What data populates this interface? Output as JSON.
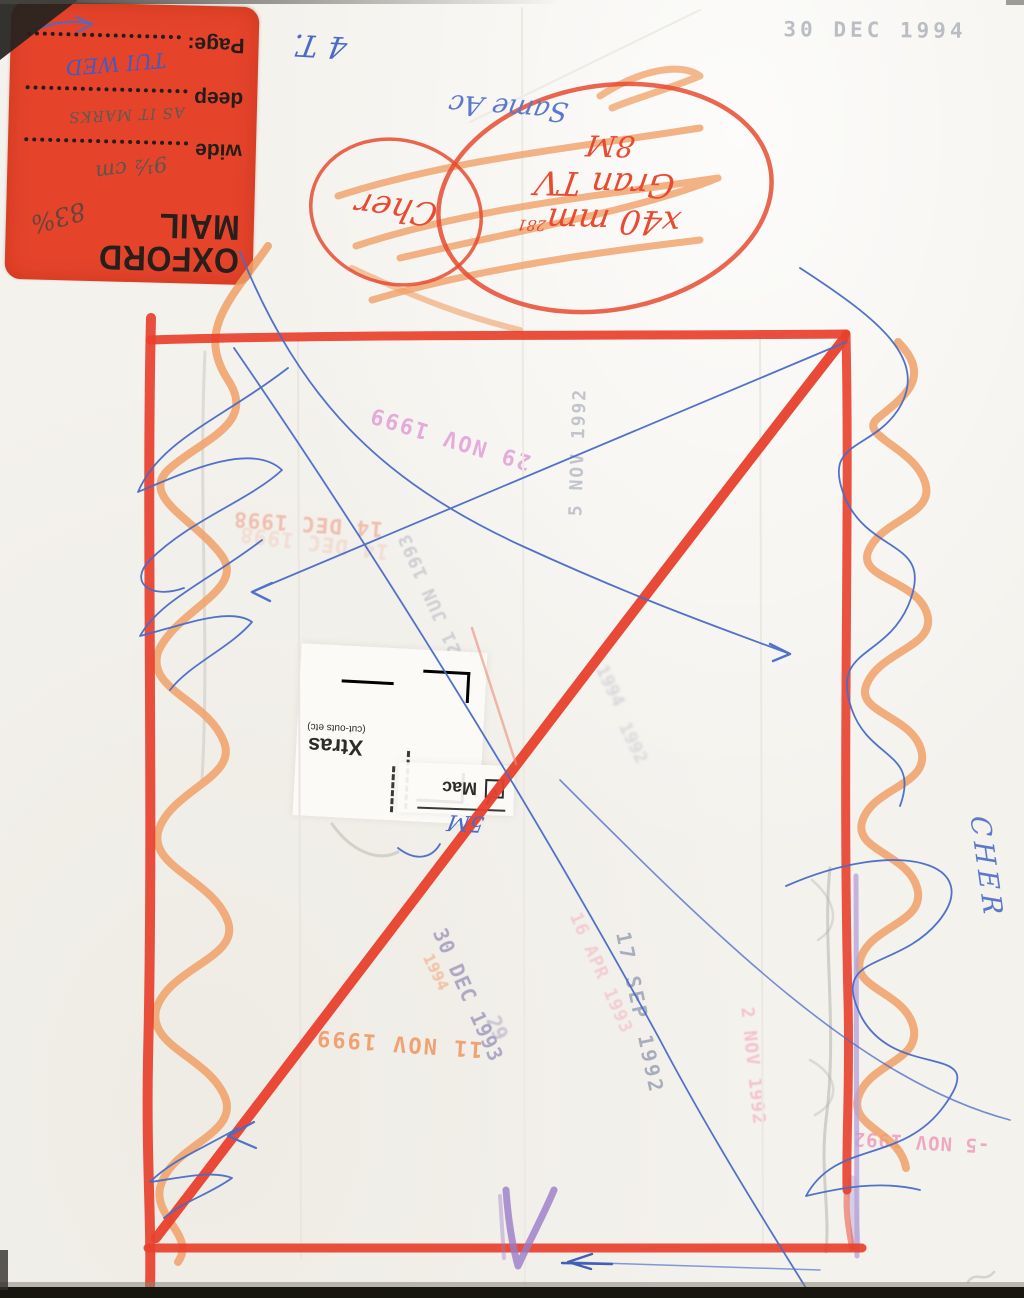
{
  "sticker": {
    "brand_line1": "OXFORD",
    "brand_line2": "MAIL",
    "percent_note": "83%",
    "bg_color": "#e5442b",
    "fields": [
      {
        "label": "wide",
        "value": "9½ cm"
      },
      {
        "label": "deep",
        "value": "AS IT MARKS"
      },
      {
        "label": "Page:",
        "value": "TUI WED"
      }
    ]
  },
  "handwriting": {
    "corner_note": "4 T.",
    "size_note_line1": "x40 mm",
    "size_note_ref": "281",
    "size_note_line2": "Gran TV",
    "size_note_line3": "8M",
    "subject_circled": "Cher",
    "blue_note": "Same Ac",
    "mac_size_note": "5M",
    "subject_margin": "CHER"
  },
  "cutout_label": {
    "title": "Xtras",
    "subtitle": "(cut-outs etc)",
    "checkbox_label": "Mac",
    "tick": "✓"
  },
  "stamps": [
    {
      "text": "30 DEC 1994",
      "ink": "#b7bbc1"
    },
    {
      "text": "29 NOV 1999",
      "ink": "#e09ad6"
    },
    {
      "text": "5 NOV 1992",
      "ink": "#aab0bb"
    },
    {
      "text": "14 DEC 1998",
      "ink": "#eeae9c"
    },
    {
      "text": "21 JUN 1993",
      "ink": "#b5b7c3"
    },
    {
      "text": "1994",
      "ink": "#b7bac4"
    },
    {
      "text": "1992",
      "ink": "#b7bac4"
    },
    {
      "text": "30 DEC 1993",
      "ink": "#9d96bc"
    },
    {
      "text": "29",
      "ink": "#9d96bc"
    },
    {
      "text": "1994",
      "ink": "#f2aa80"
    },
    {
      "text": "16 APR 1993",
      "ink": "#f3bcc8"
    },
    {
      "text": "17 SEP 1992",
      "ink": "#9aa2b4"
    },
    {
      "text": "11 NOV 1999",
      "ink": "#ef9a66"
    },
    {
      "text": "2 NOV 1992",
      "ink": "#f3b2c8"
    },
    {
      "text": "-5 NOV 1992",
      "ink": "#ee9cbc"
    }
  ],
  "colors": {
    "red_crayon": "#e8402c",
    "orange_crayon": "#f0a066",
    "blue_pen": "#4a6bc8",
    "lavender_marker": "#b6a2da",
    "purple_mark": "#9a7cc8"
  }
}
